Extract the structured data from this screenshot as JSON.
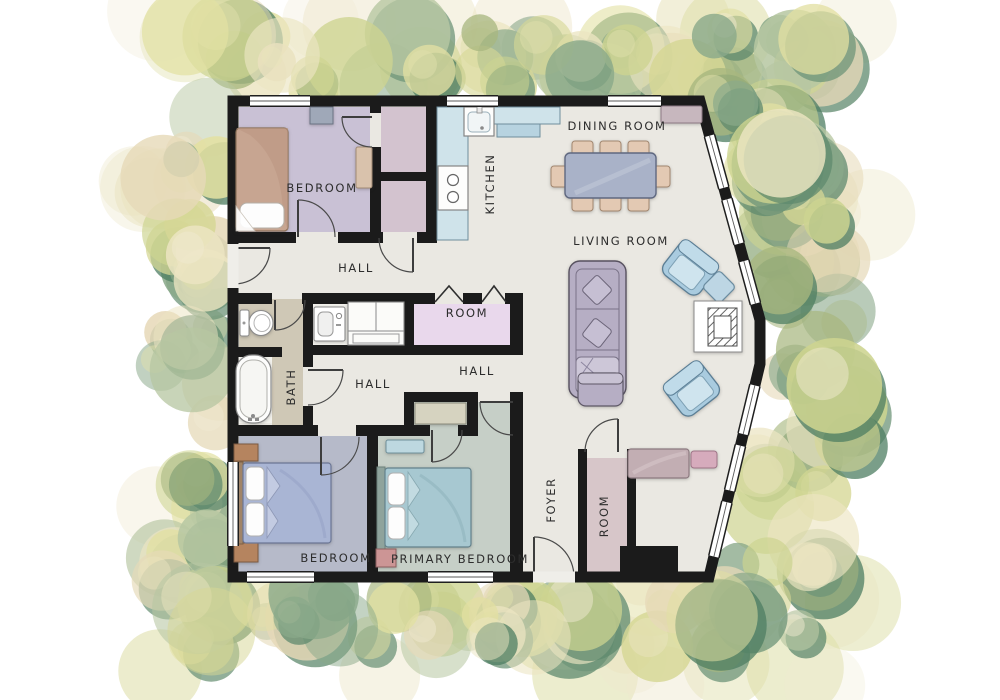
{
  "title": "Single-story house floor plan with landscaped border",
  "rooms": {
    "bedroom_tl": "BEDROOM",
    "kitchen": "KITCHEN",
    "dining_room": "DINING ROOM",
    "living_room": "LIVING ROOM",
    "hall_top": "HALL",
    "room_mid": "ROOM",
    "hall_left": "HALL",
    "hall_right": "HALL",
    "bath": "BATH",
    "bedroom_bl": "BEDROOM",
    "primary_bedroom": "PRIMARY BEDROOM",
    "foyer": "FOYER",
    "room_foyer": "ROOM"
  },
  "furniture_items": [
    "single-bed",
    "double-bed",
    "dresser",
    "desk",
    "kitchen-sink",
    "stove",
    "kitchen-counter",
    "dining-table",
    "dining-chair",
    "sideboard",
    "sofa",
    "throw-pillow",
    "armchair",
    "ottoman",
    "fireplace",
    "bench",
    "cushion",
    "toilet",
    "bathtub",
    "washing-machine",
    "wardrobe",
    "nightstand",
    "bifold-door",
    "door",
    "window"
  ],
  "colors": {
    "wall": "#1b1b1b",
    "floor_base": "#eae8e2",
    "floor_bedroom_tl": "#c9c1d5",
    "floor_closet": "#d3c3cf",
    "floor_room_mid": "#e9d8ec",
    "floor_bath": "#cfc8b6",
    "floor_wetroom": "#f3f2ed",
    "floor_bedroom_bl": "#b6bac9",
    "floor_primary": "#c6cfc7",
    "floor_foyer_closet": "#d7c6c9",
    "counter_blue": "#cfe3ea",
    "counter_blue_dark": "#b7d3e0",
    "sofa_gray": "#b6aec4",
    "armchair_blue": "#a9cbdf",
    "table_blue": "#a9b2c8",
    "chair_tan": "#e3c9b3",
    "bed_tan": "#c7a591",
    "bed_blue": "#a9b5d4",
    "bed_teal": "#a7c8d1",
    "bench_mauve": "#c2aeb3",
    "cushion_pink": "#d6abbc",
    "label_text": "#2d2d2d"
  },
  "foliage": {
    "seed": 7,
    "palette": [
      "#8aa98a",
      "#a8b77f",
      "#cdd490",
      "#e2e0a2",
      "#ece5c2",
      "#e6d9b8",
      "#b7c7a2",
      "#d6d795"
    ],
    "dark_palette": [
      "#5f8a6e",
      "#6e9478",
      "#4e7d62"
    ],
    "pale_palette": [
      "#efe9cf",
      "#e9e3bd",
      "#dfe0ab",
      "#f0ead2"
    ]
  }
}
